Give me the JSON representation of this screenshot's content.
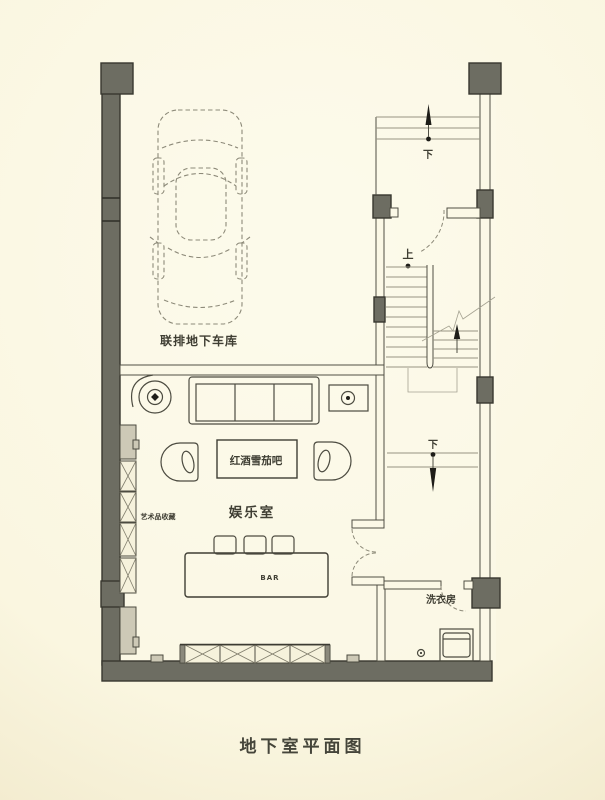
{
  "title": "地下室平面图",
  "colors": {
    "wall_fill": "#6d6d62",
    "wall_stroke": "#38372f",
    "cabinet_fill": "#cdc9b6",
    "text": "#3f3e33",
    "background_light": "#fdfbec",
    "background_edge": "#e9dfbc"
  },
  "labels": {
    "garage": "联排地下车库",
    "entertainment_room": "娱乐室",
    "wine_cigar_bar": "红酒雪茄吧",
    "art_collection": "艺术品收藏",
    "bar_counter": "BAR",
    "laundry_room": "洗衣房",
    "stair_up": "上",
    "stair_down_entry": "下",
    "stair_down_hall": "下"
  }
}
